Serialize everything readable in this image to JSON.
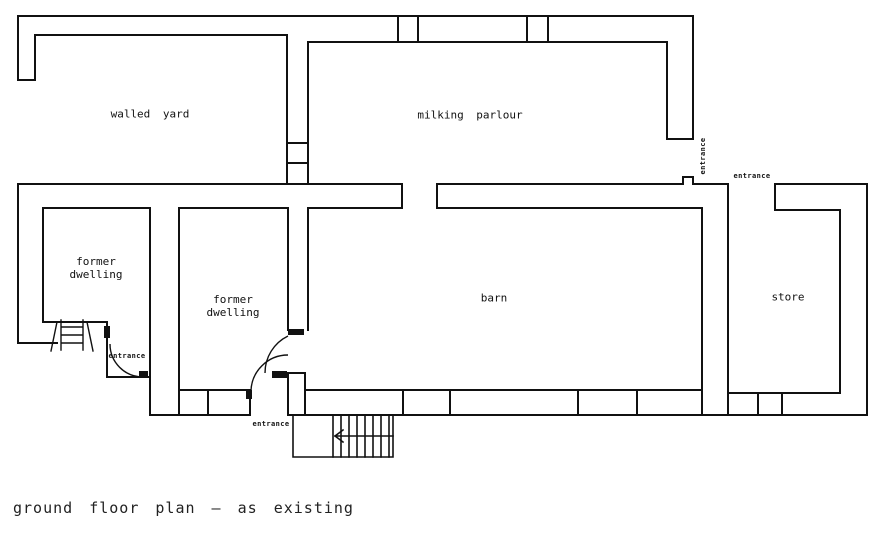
{
  "colors": {
    "line": "#111111",
    "background": "#ffffff",
    "text": "#111111"
  },
  "rooms": {
    "walled_yard": {
      "label": "walled yard"
    },
    "milking_parlour": {
      "label": "milking parlour"
    },
    "former_dwelling_1": {
      "line1": "former",
      "line2": "dwelling"
    },
    "former_dwelling_2": {
      "line1": "former",
      "line2": "dwelling"
    },
    "barn": {
      "label": "barn"
    },
    "store": {
      "label": "store"
    }
  },
  "entrances": {
    "dwelling_entrance": "entrance",
    "barn_south_entrance": "entrance",
    "parlour_side_entrance": "entrance",
    "store_entrance": "entrance"
  },
  "caption": "ground floor plan — as existing"
}
